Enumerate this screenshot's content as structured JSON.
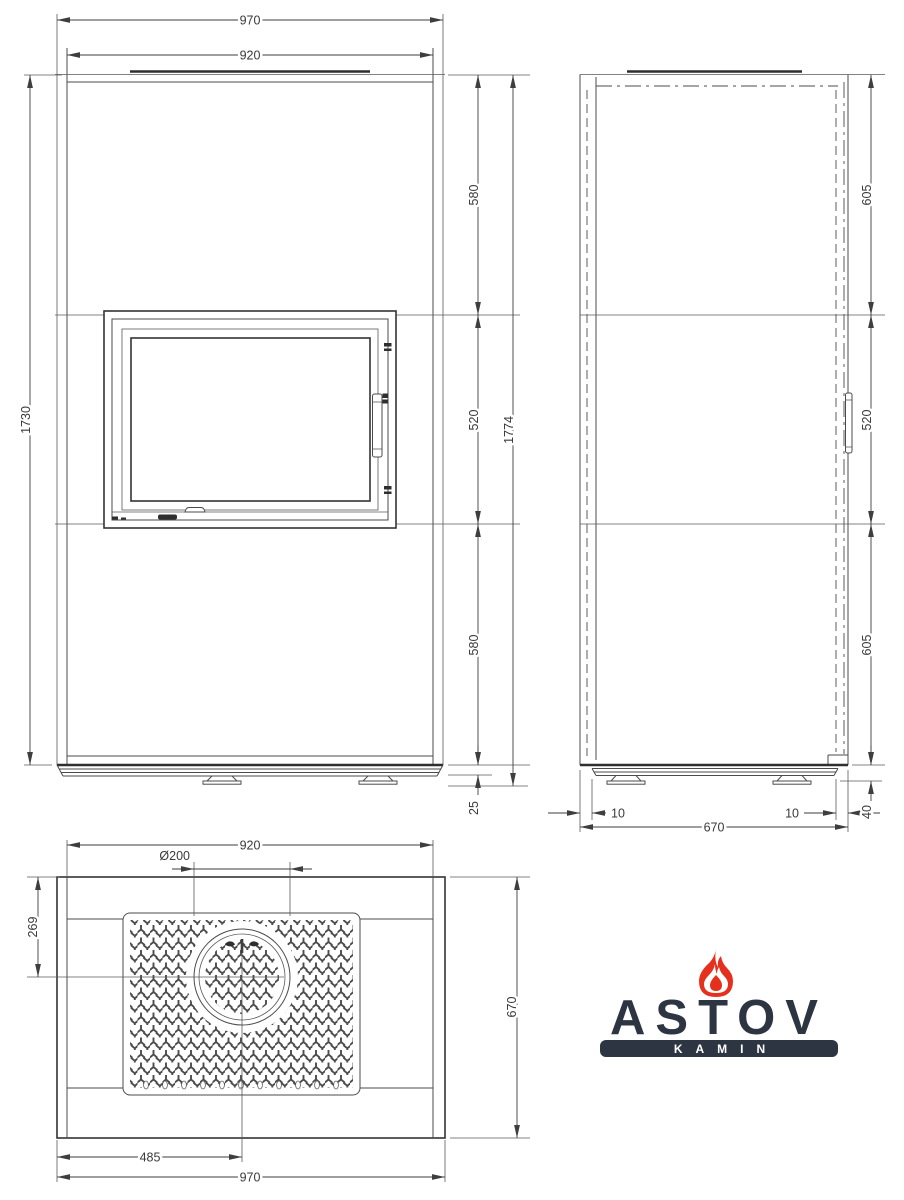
{
  "drawing": {
    "front": {
      "width_top": "970",
      "width_body": "920",
      "height_left": "1730",
      "seg_top": "580",
      "seg_mid": "520",
      "seg_bot": "580",
      "height_overall": "1774",
      "base_height": "25"
    },
    "side": {
      "seg_top": "605",
      "seg_mid": "520",
      "seg_bot": "605",
      "base_inset_left": "10",
      "base_inset_right": "10",
      "depth": "670",
      "base_height": "40"
    },
    "top": {
      "width_body": "920",
      "flue_diameter": "Ø200",
      "flue_offset": "269",
      "depth": "670",
      "flue_center_x": "485",
      "width_total": "970"
    },
    "line_color": "#4b4b4b"
  },
  "logo": {
    "brand": "ASTOV",
    "sub": "KAMIN",
    "flame_icon": "flame-icon",
    "colors": {
      "dark": "#2d3442",
      "flame": "#e5301d",
      "sub_text": "#ffffff"
    }
  }
}
